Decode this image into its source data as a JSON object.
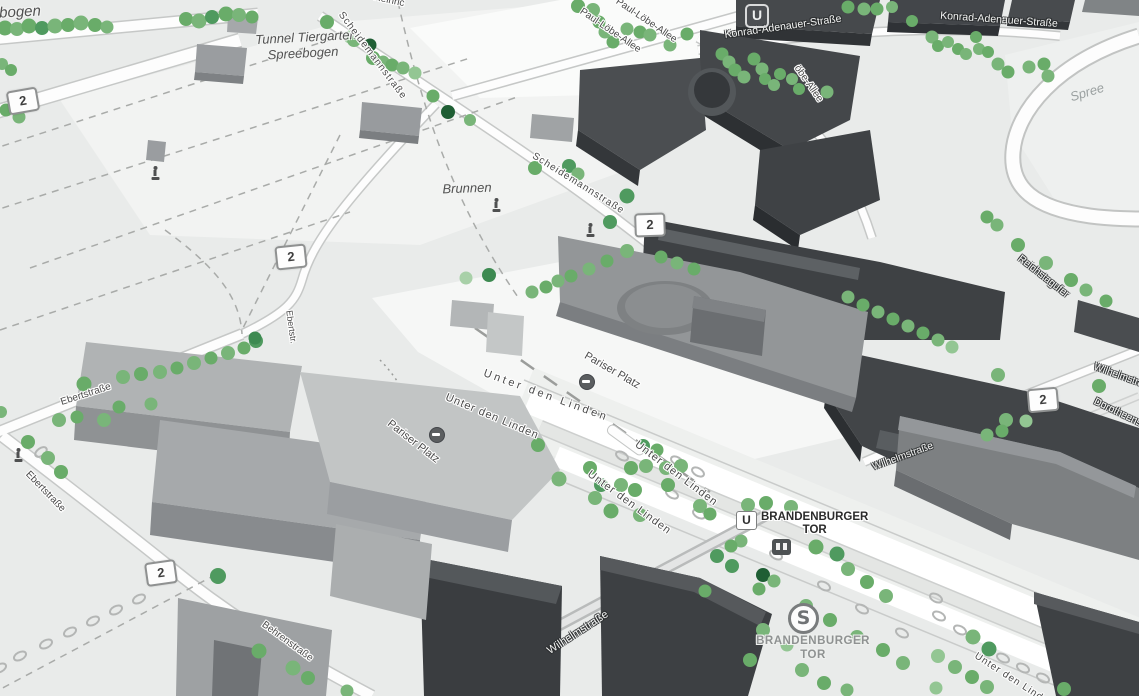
{
  "map": {
    "tree_palette": [
      "#79b579",
      "#69ac69",
      "#93c693",
      "#4f9a5f",
      "#1f5e34",
      "#a8d0a8",
      "#3d8a51"
    ],
    "icons": {
      "u_bahn_logo": {
        "text": "U"
      },
      "s_bahn_logo": {
        "text": "S"
      },
      "station_entrance": "subway-entrance"
    },
    "u_station": {
      "u": "U",
      "line1": "BRANDENBURGER",
      "line2": "TOR"
    },
    "s_station": {
      "line1": "BRANDENBURGER",
      "line2": "TOR"
    },
    "shields": [
      [
        23,
        101,
        -10
      ],
      [
        291,
        257,
        -6
      ],
      [
        650,
        225,
        -2
      ],
      [
        1043,
        400,
        -5
      ],
      [
        161,
        573,
        -8
      ]
    ],
    "shield_text": "2",
    "labels": [
      {
        "t": "bogen",
        "x": 20,
        "y": 12,
        "r": -3,
        "s": "i",
        "f": 15
      },
      {
        "t": "Tunnel Tiergarten",
        "x": 306,
        "y": 37,
        "r": -3,
        "s": "i",
        "f": 13
      },
      {
        "t": "Spreebogen",
        "x": 303,
        "y": 53,
        "r": -3,
        "s": "i",
        "f": 13
      },
      {
        "t": "Heinric",
        "x": 389,
        "y": 1,
        "r": 12,
        "s": "d",
        "f": 10
      },
      {
        "t": "Paul-Löbe-Allee",
        "x": 646,
        "y": 21,
        "r": 34,
        "s": "d",
        "f": 10
      },
      {
        "t": "Paul-Löbe-Allee",
        "x": 610,
        "y": 31,
        "r": 34,
        "s": "d",
        "f": 10
      },
      {
        "t": "öbe-Allee",
        "x": 808,
        "y": 84,
        "r": 55,
        "s": "d",
        "f": 10
      },
      {
        "t": "Konrad-Adenauer-Straße",
        "x": 783,
        "y": 27,
        "r": -8,
        "s": "w",
        "f": 10.5
      },
      {
        "t": "Konrad-Adenauer-Straße",
        "x": 999,
        "y": 20,
        "r": 4,
        "s": "w",
        "f": 10.5
      },
      {
        "t": "Spree",
        "x": 1087,
        "y": 92,
        "r": -17,
        "s": "wa",
        "f": 13
      },
      {
        "t": "Scheidemannstraße",
        "x": 372,
        "y": 56,
        "r": 53,
        "s": "d",
        "f": 10,
        "ls": 1
      },
      {
        "t": "Scheidemannstraße",
        "x": 578,
        "y": 184,
        "r": 32,
        "s": "d",
        "f": 10,
        "ls": 1
      },
      {
        "t": "Brunnen",
        "x": 467,
        "y": 188,
        "r": -2,
        "s": "i",
        "f": 13
      },
      {
        "t": "Reichstagufer",
        "x": 1043,
        "y": 277,
        "r": 38,
        "s": "w",
        "f": 10
      },
      {
        "t": "Wilhelmstraße",
        "x": 1124,
        "y": 378,
        "r": 20,
        "s": "w",
        "f": 10
      },
      {
        "t": "Dorotheenstraße",
        "x": 1128,
        "y": 418,
        "r": 26,
        "s": "w",
        "f": 10
      },
      {
        "t": "Wilhelmstraße",
        "x": 903,
        "y": 457,
        "r": -20,
        "s": "w",
        "f": 10
      },
      {
        "t": "Ebertstraße",
        "x": 86,
        "y": 395,
        "r": -18,
        "s": "d",
        "f": 10
      },
      {
        "t": "Ebertstr.",
        "x": 291,
        "y": 327,
        "r": 82,
        "s": "d",
        "f": 9
      },
      {
        "t": "Ebertstraße",
        "x": 45,
        "y": 492,
        "r": 46,
        "s": "d",
        "f": 10
      },
      {
        "t": "Behrenstraße",
        "x": 287,
        "y": 642,
        "r": 36,
        "s": "d",
        "f": 10
      },
      {
        "t": "Pariser Platz",
        "x": 413,
        "y": 442,
        "r": 38,
        "s": "d",
        "f": 11
      },
      {
        "t": "Pariser Platz",
        "x": 612,
        "y": 371,
        "r": 30,
        "s": "d",
        "f": 11
      },
      {
        "t": "Unter den Linden",
        "x": 546,
        "y": 396,
        "r": 20,
        "s": "d",
        "f": 11,
        "ls": 3
      },
      {
        "t": "Unter den Linden",
        "x": 492,
        "y": 417,
        "r": 23,
        "s": "d",
        "f": 11,
        "ls": 1
      },
      {
        "t": "Unter den Linden",
        "x": 676,
        "y": 474,
        "r": 37,
        "s": "d",
        "f": 11,
        "ls": 1
      },
      {
        "t": "Unter den Linden",
        "x": 629,
        "y": 503,
        "r": 36,
        "s": "d",
        "f": 11,
        "ls": 1
      },
      {
        "t": "Unter den Linden",
        "x": 1014,
        "y": 681,
        "r": 33,
        "s": "d",
        "f": 10,
        "ls": 1
      },
      {
        "t": "Wilhelmstraße",
        "x": 578,
        "y": 633,
        "r": -33,
        "s": "w",
        "f": 11
      }
    ],
    "statues": [
      [
        496,
        205
      ],
      [
        590,
        230
      ],
      [
        18,
        455
      ],
      [
        155,
        173
      ]
    ],
    "gates": [
      [
        587,
        382
      ],
      [
        437,
        435
      ]
    ],
    "ovals": [
      [
        20,
        656,
        -28
      ],
      [
        46,
        644,
        -28
      ],
      [
        70,
        632,
        -28
      ],
      [
        93,
        621,
        -28
      ],
      [
        116,
        610,
        -28
      ],
      [
        139,
        599,
        -28
      ],
      [
        0,
        668,
        -28
      ],
      [
        41,
        452,
        -35
      ],
      [
        776,
        555,
        28
      ],
      [
        824,
        586,
        28
      ],
      [
        862,
        609,
        28
      ],
      [
        936,
        598,
        28
      ],
      [
        939,
        616,
        28
      ],
      [
        960,
        630,
        28
      ],
      [
        1003,
        658,
        28
      ],
      [
        1023,
        668,
        28
      ],
      [
        1043,
        678,
        28
      ],
      [
        902,
        633,
        28
      ],
      [
        622,
        456,
        30
      ],
      [
        677,
        461,
        30
      ],
      [
        698,
        472,
        30
      ],
      [
        672,
        494,
        30
      ],
      [
        699,
        514,
        30
      ]
    ],
    "trees": [
      [
        5,
        28,
        15,
        1
      ],
      [
        17,
        29,
        14,
        0
      ],
      [
        29,
        26,
        15,
        1
      ],
      [
        42,
        28,
        14,
        3
      ],
      [
        55,
        26,
        15,
        0
      ],
      [
        68,
        25,
        14,
        1
      ],
      [
        81,
        23,
        15,
        0
      ],
      [
        95,
        25,
        14,
        1
      ],
      [
        107,
        27,
        13,
        0
      ],
      [
        186,
        19,
        14,
        1
      ],
      [
        199,
        21,
        15,
        0
      ],
      [
        212,
        17,
        14,
        3
      ],
      [
        226,
        14,
        15,
        1
      ],
      [
        239,
        15,
        14,
        0
      ],
      [
        252,
        17,
        13,
        1
      ],
      [
        2,
        64,
        12,
        0
      ],
      [
        11,
        70,
        12,
        1
      ],
      [
        6,
        110,
        13,
        1
      ],
      [
        19,
        117,
        13,
        0
      ],
      [
        327,
        22,
        14,
        1
      ],
      [
        350,
        37,
        13,
        5
      ],
      [
        354,
        40,
        14,
        0
      ],
      [
        370,
        45,
        13,
        4
      ],
      [
        373,
        58,
        14,
        1
      ],
      [
        383,
        62,
        13,
        0
      ],
      [
        392,
        65,
        13,
        1
      ],
      [
        403,
        68,
        13,
        0
      ],
      [
        415,
        73,
        13,
        2
      ],
      [
        433,
        96,
        13,
        1
      ],
      [
        448,
        112,
        14,
        4
      ],
      [
        470,
        120,
        12,
        0
      ],
      [
        535,
        168,
        14,
        1
      ],
      [
        569,
        166,
        14,
        3
      ],
      [
        578,
        174,
        13,
        0
      ],
      [
        627,
        196,
        15,
        3
      ],
      [
        610,
        222,
        14,
        3
      ],
      [
        627,
        251,
        14,
        0
      ],
      [
        661,
        257,
        13,
        1
      ],
      [
        677,
        263,
        13,
        0
      ],
      [
        694,
        269,
        13,
        1
      ],
      [
        607,
        261,
        13,
        1
      ],
      [
        589,
        269,
        13,
        0
      ],
      [
        571,
        276,
        13,
        1
      ],
      [
        558,
        281,
        13,
        0
      ],
      [
        546,
        287,
        13,
        1
      ],
      [
        532,
        292,
        13,
        0
      ],
      [
        489,
        275,
        14,
        6
      ],
      [
        466,
        278,
        13,
        5
      ],
      [
        84,
        384,
        15,
        1
      ],
      [
        123,
        377,
        14,
        0
      ],
      [
        141,
        374,
        14,
        1
      ],
      [
        160,
        372,
        14,
        0
      ],
      [
        177,
        368,
        13,
        1
      ],
      [
        194,
        363,
        14,
        0
      ],
      [
        211,
        358,
        13,
        1
      ],
      [
        228,
        353,
        14,
        0
      ],
      [
        244,
        348,
        13,
        1
      ],
      [
        256,
        341,
        14,
        3
      ],
      [
        59,
        420,
        14,
        0
      ],
      [
        77,
        417,
        13,
        1
      ],
      [
        104,
        420,
        14,
        0
      ],
      [
        119,
        407,
        13,
        1
      ],
      [
        151,
        404,
        13,
        0
      ],
      [
        28,
        442,
        14,
        1
      ],
      [
        48,
        458,
        14,
        0
      ],
      [
        61,
        472,
        14,
        1
      ],
      [
        1,
        412,
        12,
        0
      ],
      [
        218,
        576,
        16,
        3
      ],
      [
        259,
        651,
        15,
        1
      ],
      [
        293,
        668,
        15,
        0
      ],
      [
        308,
        678,
        14,
        1
      ],
      [
        347,
        691,
        13,
        0
      ],
      [
        255,
        338,
        13,
        6
      ],
      [
        578,
        6,
        14,
        1
      ],
      [
        593,
        10,
        14,
        0
      ],
      [
        599,
        22,
        13,
        1
      ],
      [
        605,
        32,
        13,
        0
      ],
      [
        613,
        42,
        13,
        1
      ],
      [
        627,
        29,
        13,
        0
      ],
      [
        640,
        32,
        13,
        1
      ],
      [
        650,
        35,
        13,
        0
      ],
      [
        687,
        34,
        13,
        1
      ],
      [
        670,
        45,
        13,
        0
      ],
      [
        722,
        54,
        13,
        1
      ],
      [
        729,
        62,
        13,
        0
      ],
      [
        735,
        70,
        13,
        1
      ],
      [
        744,
        77,
        13,
        0
      ],
      [
        754,
        59,
        13,
        1
      ],
      [
        762,
        69,
        13,
        0
      ],
      [
        765,
        79,
        12,
        1
      ],
      [
        774,
        85,
        12,
        0
      ],
      [
        780,
        74,
        12,
        1
      ],
      [
        792,
        79,
        12,
        0
      ],
      [
        799,
        89,
        12,
        1
      ],
      [
        827,
        92,
        13,
        0
      ],
      [
        848,
        7,
        13,
        1
      ],
      [
        864,
        9,
        13,
        0
      ],
      [
        877,
        9,
        13,
        1
      ],
      [
        892,
        7,
        12,
        0
      ],
      [
        912,
        21,
        12,
        1
      ],
      [
        932,
        37,
        13,
        0
      ],
      [
        938,
        46,
        12,
        1
      ],
      [
        948,
        42,
        12,
        0
      ],
      [
        958,
        49,
        12,
        1
      ],
      [
        966,
        54,
        12,
        0
      ],
      [
        976,
        37,
        12,
        1
      ],
      [
        979,
        49,
        12,
        0
      ],
      [
        988,
        52,
        12,
        1
      ],
      [
        998,
        64,
        13,
        0
      ],
      [
        1008,
        72,
        13,
        1
      ],
      [
        1029,
        67,
        13,
        0
      ],
      [
        1044,
        64,
        13,
        1
      ],
      [
        1048,
        76,
        13,
        0
      ],
      [
        987,
        217,
        13,
        1
      ],
      [
        997,
        225,
        13,
        0
      ],
      [
        1018,
        245,
        14,
        1
      ],
      [
        1046,
        263,
        14,
        0
      ],
      [
        1071,
        280,
        14,
        1
      ],
      [
        1086,
        290,
        13,
        0
      ],
      [
        1106,
        301,
        13,
        1
      ],
      [
        848,
        297,
        13,
        0
      ],
      [
        863,
        305,
        13,
        1
      ],
      [
        878,
        312,
        13,
        0
      ],
      [
        893,
        319,
        13,
        1
      ],
      [
        908,
        326,
        13,
        0
      ],
      [
        923,
        333,
        13,
        1
      ],
      [
        938,
        340,
        13,
        0
      ],
      [
        952,
        347,
        13,
        2
      ],
      [
        998,
        375,
        14,
        0
      ],
      [
        1099,
        386,
        14,
        1
      ],
      [
        1006,
        420,
        14,
        0
      ],
      [
        1026,
        421,
        13,
        2
      ],
      [
        1002,
        431,
        13,
        1
      ],
      [
        987,
        435,
        13,
        0
      ],
      [
        538,
        445,
        14,
        1
      ],
      [
        559,
        479,
        15,
        0
      ],
      [
        590,
        468,
        14,
        1
      ],
      [
        595,
        498,
        14,
        0
      ],
      [
        601,
        485,
        14,
        3
      ],
      [
        611,
        511,
        15,
        1
      ],
      [
        621,
        485,
        14,
        0
      ],
      [
        631,
        468,
        14,
        1
      ],
      [
        643,
        446,
        14,
        3
      ],
      [
        646,
        466,
        14,
        0
      ],
      [
        635,
        490,
        14,
        1
      ],
      [
        640,
        515,
        14,
        0
      ],
      [
        657,
        450,
        13,
        1
      ],
      [
        666,
        468,
        14,
        0
      ],
      [
        668,
        485,
        14,
        1
      ],
      [
        681,
        466,
        14,
        0
      ],
      [
        700,
        506,
        14,
        0
      ],
      [
        710,
        514,
        13,
        1
      ],
      [
        748,
        505,
        14,
        0
      ],
      [
        766,
        503,
        14,
        1
      ],
      [
        791,
        507,
        14,
        0
      ],
      [
        816,
        547,
        15,
        1
      ],
      [
        837,
        554,
        15,
        3
      ],
      [
        848,
        569,
        14,
        0
      ],
      [
        867,
        582,
        14,
        1
      ],
      [
        886,
        596,
        14,
        0
      ],
      [
        741,
        541,
        13,
        0
      ],
      [
        731,
        546,
        13,
        1
      ],
      [
        717,
        556,
        14,
        3
      ],
      [
        732,
        566,
        14,
        3
      ],
      [
        763,
        575,
        14,
        4
      ],
      [
        774,
        581,
        13,
        0
      ],
      [
        759,
        589,
        13,
        1
      ],
      [
        806,
        606,
        14,
        0
      ],
      [
        830,
        620,
        14,
        1
      ],
      [
        857,
        637,
        14,
        0
      ],
      [
        883,
        650,
        14,
        1
      ],
      [
        903,
        663,
        14,
        0
      ],
      [
        705,
        591,
        13,
        1
      ],
      [
        763,
        630,
        14,
        0
      ],
      [
        787,
        645,
        13,
        2
      ],
      [
        750,
        660,
        14,
        1
      ],
      [
        802,
        670,
        14,
        0
      ],
      [
        824,
        683,
        14,
        1
      ],
      [
        847,
        690,
        13,
        0
      ],
      [
        973,
        637,
        15,
        0
      ],
      [
        989,
        649,
        15,
        3
      ],
      [
        938,
        656,
        14,
        2
      ],
      [
        955,
        667,
        14,
        0
      ],
      [
        972,
        677,
        14,
        1
      ],
      [
        987,
        687,
        14,
        0
      ],
      [
        936,
        688,
        13,
        2
      ],
      [
        1064,
        689,
        14,
        1
      ]
    ]
  }
}
